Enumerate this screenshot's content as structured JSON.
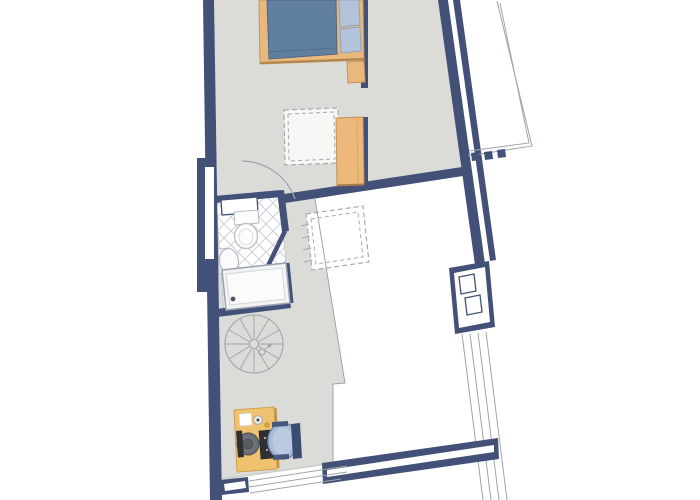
{
  "meta": {
    "title": "apartment-floor-plan",
    "canvas": {
      "width": 700,
      "height": 500,
      "background": "#ffffff"
    }
  },
  "palette": {
    "wall": "#435078",
    "floor": "#dbdbd8",
    "floor_edge": "#c6c8c4",
    "thin": "#9fa5ad",
    "dash": "#a6abb3",
    "tile_line": "#ccd0d8",
    "white": "#ffffff",
    "wood": "#e9b87d",
    "wood_dark": "#c3945a",
    "wood_shadow": "#b0854e",
    "wardrobe_shadow": "#a87c49",
    "desk": "#eec26f",
    "desk_edge": "#cfa049",
    "desk_shadow": "#c08f3e",
    "blanket": "#61809f",
    "blanket_edge": "#4c6884",
    "pillow": "#b3c4da",
    "pillow_edge": "#8fa3bd",
    "chair_seat": "#a9bdd9",
    "chair_seat_light": "#bccadf",
    "chair_rim": "#7089b0",
    "chair_back": "#3c4d72",
    "chair_arm": "#46587c",
    "dark": "#2e3034",
    "monitor": "#6b6f74",
    "fixture_line": "#b5bac2",
    "accent_yellow": "#d8a93c"
  },
  "elements": [
    {
      "name": "floor-area",
      "kind": "polygon",
      "pts": "214,0 445,0 463,171 315,199 345,383 333,384 333,464 222,480",
      "fill": "$floor"
    },
    {
      "name": "roof-window-dashed-outer",
      "kind": "polygon",
      "pts": "306,214 363,206 369,262 312,270",
      "fill": "#ffffff",
      "stroke": "$dash",
      "sw": 1.2,
      "dash": "5 3"
    },
    {
      "name": "roof-window-dashed-inner",
      "kind": "polygon",
      "pts": "311,219 358,212 363,257 316,264",
      "fill": "none",
      "stroke": "$dash",
      "sw": 1,
      "dash": "4 3"
    },
    {
      "name": "roof-hatch-line",
      "kind": "line",
      "x1": 301,
      "y1": 226,
      "x2": 309,
      "y2": 224,
      "stroke": "$dash",
      "sw": 1
    },
    {
      "name": "roof-hatch-line",
      "kind": "line",
      "x1": 302,
      "y1": 238,
      "x2": 310,
      "y2": 236,
      "stroke": "$dash",
      "sw": 1
    },
    {
      "name": "roof-hatch-line",
      "kind": "line",
      "x1": 303,
      "y1": 250,
      "x2": 311,
      "y2": 248,
      "stroke": "$dash",
      "sw": 1
    },
    {
      "name": "roof-hatch-line",
      "kind": "line",
      "x1": 304,
      "y1": 262,
      "x2": 312,
      "y2": 260,
      "stroke": "$dash",
      "sw": 1
    },
    {
      "name": "area-boundary-line",
      "kind": "polyline",
      "pts": "315,199 345,383 333,384 333,464",
      "fill": "none",
      "stroke": "$thin",
      "sw": 1
    },
    {
      "name": "floor-edge-line",
      "kind": "line",
      "x1": 222,
      "y1": 479,
      "x2": 334,
      "y2": 463,
      "stroke": "$floor_edge",
      "sw": 1
    },
    {
      "name": "skylight-dashed-outer",
      "kind": "polygon",
      "pts": "284,110 338,108 339,163 285,165",
      "fill": "#f7f7f5",
      "stroke": "$dash",
      "sw": 1.2,
      "dash": "5 3"
    },
    {
      "name": "skylight-dashed-inner",
      "kind": "polygon",
      "pts": "288,114 334,112 335,159 289,161",
      "fill": "none",
      "stroke": "$dash",
      "sw": 1,
      "dash": "4 3"
    },
    {
      "name": "spiral-stair-outer-circle",
      "kind": "circle",
      "cx": 254,
      "cy": 344,
      "r": 29,
      "fill": "none",
      "stroke": "$thin",
      "sw": 1.1
    },
    {
      "name": "spiral-stair-hub",
      "kind": "circle",
      "cx": 254,
      "cy": 344,
      "r": 4.5,
      "fill": "none",
      "stroke": "$thin",
      "sw": 1
    },
    {
      "name": "stair-spoke",
      "kind": "line",
      "x1": 259,
      "y1": 344,
      "x2": 283,
      "y2": 344,
      "stroke": "$thin",
      "sw": 0.9
    },
    {
      "name": "stair-spoke",
      "kind": "line",
      "x1": 258,
      "y1": 346,
      "x2": 279,
      "y2": 359,
      "stroke": "$thin",
      "sw": 0.9
    },
    {
      "name": "stair-spoke",
      "kind": "line",
      "x1": 256,
      "y1": 348,
      "x2": 269,
      "y2": 369,
      "stroke": "$thin",
      "sw": 0.9
    },
    {
      "name": "stair-spoke",
      "kind": "line",
      "x1": 254,
      "y1": 349,
      "x2": 254,
      "y2": 373,
      "stroke": "$thin",
      "sw": 0.9
    },
    {
      "name": "stair-spoke",
      "kind": "line",
      "x1": 252,
      "y1": 348,
      "x2": 240,
      "y2": 369,
      "stroke": "$thin",
      "sw": 0.9
    },
    {
      "name": "stair-spoke",
      "kind": "line",
      "x1": 250,
      "y1": 346,
      "x2": 229,
      "y2": 359,
      "stroke": "$thin",
      "sw": 0.9
    },
    {
      "name": "stair-spoke",
      "kind": "line",
      "x1": 250,
      "y1": 344,
      "x2": 225,
      "y2": 344,
      "stroke": "$thin",
      "sw": 0.9
    },
    {
      "name": "stair-spoke",
      "kind": "line",
      "x1": 250,
      "y1": 342,
      "x2": 229,
      "y2": 330,
      "stroke": "$thin",
      "sw": 0.9
    },
    {
      "name": "stair-spoke",
      "kind": "line",
      "x1": 252,
      "y1": 340,
      "x2": 240,
      "y2": 319,
      "stroke": "$thin",
      "sw": 0.9
    },
    {
      "name": "stair-spoke",
      "kind": "line",
      "x1": 254,
      "y1": 340,
      "x2": 254,
      "y2": 315,
      "stroke": "$thin",
      "sw": 0.9
    },
    {
      "name": "stair-spoke",
      "kind": "line",
      "x1": 256,
      "y1": 340,
      "x2": 269,
      "y2": 319,
      "stroke": "$thin",
      "sw": 0.9
    },
    {
      "name": "stair-spoke",
      "kind": "line",
      "x1": 258,
      "y1": 342,
      "x2": 279,
      "y2": 330,
      "stroke": "$thin",
      "sw": 0.9
    },
    {
      "name": "stair-direction-circle",
      "kind": "circle",
      "cx": 262,
      "cy": 352,
      "r": 3,
      "fill": "none",
      "stroke": "$thin",
      "sw": 1
    },
    {
      "name": "stair-direction-arrow",
      "kind": "line",
      "x1": 264,
      "y1": 350,
      "x2": 271,
      "y2": 345,
      "stroke": "$thin",
      "sw": 1
    },
    {
      "name": "stair-arrowhead",
      "kind": "polygon",
      "pts": "272,344 267,345 270,348",
      "fill": "$thin"
    },
    {
      "name": "bathroom-tile-floor",
      "kind": "polygon",
      "pts": "216,201 280,195 289,300 224,311",
      "fill": "url(#tilepat)",
      "stroke": "#b9bec6",
      "sw": 0.6
    },
    {
      "name": "bathroom-top-wall",
      "kind": "polygon",
      "pts": "214,196 281,190 282,197 215,203",
      "fill": "$wall"
    },
    {
      "name": "bathroom-right-wall",
      "kind": "polygon",
      "pts": "277,191 284,190 289,231 282,232",
      "fill": "$wall"
    },
    {
      "name": "bathroom-partition-wall",
      "kind": "line",
      "x1": 285,
      "y1": 231,
      "x2": 263,
      "y2": 276,
      "stroke": "$wall",
      "sw": 4.5
    },
    {
      "name": "shower-side-wall",
      "kind": "line",
      "x1": 287,
      "y1": 263,
      "x2": 291,
      "y2": 303,
      "stroke": "$wall",
      "sw": 5
    },
    {
      "name": "bathroom-bottom-wall",
      "kind": "polygon",
      "pts": "216,309 290,300 291,308 217,317",
      "fill": "$wall"
    },
    {
      "name": "bathroom-door-panel",
      "kind": "polygon",
      "pts": "221,200 257,197 258,212 222,215",
      "fill": "#ffffff",
      "stroke": "$wall",
      "sw": 1.3
    },
    {
      "name": "toilet-tank",
      "kind": "polygon",
      "pts": "234,212 258,210 259,223 235,225",
      "fill": "#fcfcfc",
      "stroke": "$fixture_line",
      "sw": 1
    },
    {
      "name": "toilet-bowl",
      "kind": "ellipse",
      "cx": 246,
      "cy": 236,
      "rx": 11.5,
      "ry": 12.5,
      "fill": "#fdfdfd",
      "stroke": "$fixture_line",
      "sw": 1.2
    },
    {
      "name": "toilet-bowl-inner",
      "kind": "ellipse",
      "cx": 246,
      "cy": 237,
      "rx": 7,
      "ry": 8,
      "fill": "none",
      "stroke": "#d8dbdf",
      "sw": 1
    },
    {
      "name": "sink-pedestal",
      "kind": "polygon",
      "pts": "218,249 227,248 228,273 219,274",
      "fill": "#edeef1",
      "stroke": "$fixture_line",
      "sw": 0.8
    },
    {
      "name": "sink-basin",
      "kind": "ellipse",
      "cx": 229,
      "cy": 261,
      "rx": 9.5,
      "ry": 12.5,
      "fill": "#fbfbfc",
      "stroke": "$fixture_line",
      "sw": 1.2,
      "rot": [
        -8,
        229,
        261
      ]
    },
    {
      "name": "shower-tray",
      "kind": "polygon",
      "pts": "222,270 286,263 290,303 226,310",
      "fill": "#f2f3f2",
      "stroke": "#99a2b2",
      "sw": 1.5
    },
    {
      "name": "shower-tray-inner",
      "kind": "polygon",
      "pts": "226,274 282,268 285,299 230,305",
      "fill": "#fbfbfb",
      "stroke": "#d3d6da",
      "sw": 1
    },
    {
      "name": "shower-drain",
      "kind": "circle",
      "cx": 233,
      "cy": 299,
      "r": 2.4,
      "fill": "#51555c"
    },
    {
      "name": "left-wall",
      "kind": "polygon",
      "pts": "203,0 214,0 222,500 210,500",
      "fill": "$wall"
    },
    {
      "name": "left-wall-alcove",
      "kind": "polygon",
      "pts": "197,158 216,158 216,292 197,292",
      "fill": "$wall"
    },
    {
      "name": "left-window",
      "kind": "polygon",
      "pts": "205,167 214,167 214,259 205,259",
      "fill": "#ffffff"
    },
    {
      "name": "closet-wall-upper",
      "kind": "polygon",
      "pts": "361,0 368,0 368,88 361,88",
      "fill": "$wall"
    },
    {
      "name": "closet-wall-lower",
      "kind": "polygon",
      "pts": "361,117 368,117 368,185 361,185",
      "fill": "$wall"
    },
    {
      "name": "interior-wall",
      "kind": "polygon",
      "pts": "284,194 462,167 463,176 285,203",
      "fill": "$wall"
    },
    {
      "name": "right-wall-outer-leaf",
      "kind": "polygon",
      "pts": "438,0 448,0 485,263 475,265",
      "fill": "$wall"
    },
    {
      "name": "right-wall-window-stripe",
      "kind": "polygon",
      "pts": "448,0 453,0 490,261 485,263",
      "fill": "#ffffff"
    },
    {
      "name": "right-wall-inner-leaf",
      "kind": "polygon",
      "pts": "453,0 460,0 496,260 490,261",
      "fill": "$wall"
    },
    {
      "name": "chimney-outer",
      "kind": "polygon",
      "pts": "449,268 489,261 495,327 455,334",
      "fill": "$wall"
    },
    {
      "name": "chimney-inner",
      "kind": "polygon",
      "pts": "454,273 485,267 490,322 459,328",
      "fill": "#ffffff"
    },
    {
      "name": "chimney-flue-1",
      "kind": "polygon",
      "pts": "459,277 474,274 476,291 461,294",
      "fill": "#ffffff",
      "stroke": "$wall",
      "sw": 1.3
    },
    {
      "name": "chimney-flue-2",
      "kind": "polygon",
      "pts": "465,298 480,295 482,312 467,315",
      "fill": "#ffffff",
      "stroke": "$wall",
      "sw": 1.3
    },
    {
      "name": "terrace-outline-outer",
      "kind": "polyline",
      "pts": "497,1 532,146 468,156",
      "fill": "none",
      "stroke": "$thin",
      "sw": 1
    },
    {
      "name": "terrace-outline-inner",
      "kind": "polyline",
      "pts": "500,3 529,143 469,151",
      "fill": "none",
      "stroke": "$thin",
      "sw": 1
    },
    {
      "name": "terrace-post",
      "kind": "polygon",
      "pts": "471,153 479,152 480,160 472,161",
      "fill": "$wall"
    },
    {
      "name": "terrace-post",
      "kind": "polygon",
      "pts": "484,152 492,151 493,159 485,160",
      "fill": "$wall"
    },
    {
      "name": "terrace-post",
      "kind": "polygon",
      "pts": "497,150 505,149 506,157 498,158",
      "fill": "$wall"
    },
    {
      "name": "railing-line",
      "kind": "line",
      "x1": 462,
      "y1": 334,
      "x2": 483,
      "y2": 500,
      "stroke": "$thin",
      "sw": 1
    },
    {
      "name": "railing-line",
      "kind": "line",
      "x1": 470,
      "y1": 334,
      "x2": 491,
      "y2": 500,
      "stroke": "$thin",
      "sw": 1
    },
    {
      "name": "railing-line",
      "kind": "line",
      "x1": 478,
      "y1": 333,
      "x2": 499,
      "y2": 500,
      "stroke": "$thin",
      "sw": 1
    },
    {
      "name": "railing-line",
      "kind": "line",
      "x1": 486,
      "y1": 332,
      "x2": 507,
      "y2": 500,
      "stroke": "$thin",
      "sw": 1
    },
    {
      "name": "south-window-band",
      "kind": "polygon",
      "pts": "322,463 498,438 499,459 323,484",
      "fill": "$wall"
    },
    {
      "name": "south-window-stripe",
      "kind": "polygon",
      "pts": "327,470 494,445 494,452 327,477",
      "fill": "#ffffff"
    },
    {
      "name": "southwest-sill",
      "kind": "polygon",
      "pts": "220,480 248,477 249,492 221,495",
      "fill": "$wall"
    },
    {
      "name": "southwest-sill-stripe",
      "kind": "polygon",
      "pts": "224,484 245,481 246,488 225,491",
      "fill": "#ffffff"
    },
    {
      "name": "southwest-window-line",
      "kind": "line",
      "x1": 249,
      "y1": 481,
      "x2": 347,
      "y2": 466,
      "stroke": "$thin",
      "sw": 1
    },
    {
      "name": "southwest-window-line",
      "kind": "line",
      "x1": 249,
      "y1": 487,
      "x2": 347,
      "y2": 472,
      "stroke": "$thin",
      "sw": 1
    },
    {
      "name": "southwest-window-line",
      "kind": "line",
      "x1": 250,
      "y1": 493,
      "x2": 341,
      "y2": 479,
      "stroke": "$thin",
      "sw": 1
    },
    {
      "name": "door-swing-arc",
      "kind": "path",
      "d": "M242,161 A57 57 0 0 1 295,199",
      "fill": "none",
      "stroke": "$thin",
      "sw": 1.2
    },
    {
      "name": "bed-frame",
      "kind": "polygon",
      "pts": "259,0 363,0 364,60 260,64",
      "fill": "$wood",
      "stroke": "$wood_dark",
      "sw": 1
    },
    {
      "name": "bed-frame-shadow",
      "kind": "line",
      "x1": 260,
      "y1": 63,
      "x2": 364,
      "y2": 59,
      "stroke": "$wood_shadow",
      "sw": 2
    },
    {
      "name": "bed-blanket",
      "kind": "polygon",
      "pts": "267,0 336,0 337,54 269,59",
      "fill": "$blanket",
      "stroke": "$blanket_edge",
      "sw": 1
    },
    {
      "name": "bed-blanket-fold",
      "kind": "line",
      "x1": 268,
      "y1": 52,
      "x2": 336,
      "y2": 48,
      "stroke": "#51708f",
      "sw": 1
    },
    {
      "name": "bed-pillow",
      "kind": "polygon",
      "pts": "339,0 359,0 360,25 340,27",
      "fill": "$pillow",
      "stroke": "$pillow_edge",
      "sw": 1
    },
    {
      "name": "bed-pillow",
      "kind": "polygon",
      "pts": "340,29 360,27 361,51 341,53",
      "fill": "$pillow",
      "stroke": "$pillow_edge",
      "sw": 1
    },
    {
      "name": "nightstand",
      "kind": "polygon",
      "pts": "347,62 364,61 365,82 348,83",
      "fill": "$wood",
      "stroke": "$wood_dark",
      "sw": 1
    },
    {
      "name": "wardrobe",
      "kind": "polygon",
      "pts": "336,118 363,117 364,184 337,185",
      "fill": "#edb97b",
      "stroke": "$wood_dark",
      "sw": 1
    },
    {
      "name": "wardrobe-panel-line",
      "kind": "line",
      "x1": 357,
      "y1": 118,
      "x2": 358,
      "y2": 183,
      "stroke": "#d9a55e",
      "sw": 1
    },
    {
      "name": "wardrobe-shadow",
      "kind": "line",
      "x1": 337,
      "y1": 185.5,
      "x2": 364,
      "y2": 184.5,
      "stroke": "$wardrobe_shadow",
      "sw": 2
    },
    {
      "name": "desk",
      "kind": "polygon",
      "pts": "234,410 274,407 277,469 237,472",
      "fill": "$desk",
      "stroke": "$desk_edge",
      "sw": 1
    },
    {
      "name": "desk-shadow-edge",
      "kind": "line",
      "x1": 275.5,
      "y1": 408,
      "x2": 278.5,
      "y2": 468,
      "stroke": "$desk_shadow",
      "sw": 2
    },
    {
      "name": "desk-paper",
      "kind": "polygon",
      "pts": "239,414 251,413 252,425 240,426",
      "fill": "#ffffff",
      "stroke": "#d8d8d6",
      "sw": 0.7
    },
    {
      "name": "desk-gadget",
      "kind": "circle",
      "cx": 258,
      "cy": 420,
      "r": 4.3,
      "fill": "#f3f3f3",
      "stroke": "$thin",
      "sw": 1
    },
    {
      "name": "desk-gadget-dot",
      "kind": "circle",
      "cx": 258,
      "cy": 420,
      "r": 1.6,
      "fill": "#555555"
    },
    {
      "name": "desk-accessory",
      "kind": "circle",
      "cx": 267,
      "cy": 425,
      "r": 2.2,
      "fill": "$accent_yellow",
      "stroke": "#a97f23",
      "sw": 0.7
    },
    {
      "name": "monitor-body",
      "kind": "circle",
      "cx": 248,
      "cy": 444,
      "r": 11,
      "fill": "$monitor",
      "stroke": "#4a4d52",
      "sw": 1
    },
    {
      "name": "monitor-ring",
      "kind": "circle",
      "cx": 248,
      "cy": 444,
      "r": 6.5,
      "fill": "#585c62",
      "stroke": "#7d8187",
      "sw": 1
    },
    {
      "name": "monitor-screen",
      "kind": "polygon",
      "pts": "236,431 242,430.5 244,457 238,457.5",
      "fill": "$dark"
    },
    {
      "name": "keyboard",
      "kind": "polygon",
      "pts": "259,431 271,430 273,458 261,459",
      "fill": "$dark",
      "stroke": "#17191c",
      "sw": 0.6
    },
    {
      "name": "keyboard-key-dot",
      "kind": "circle",
      "cx": 265,
      "cy": 438,
      "r": 1,
      "fill": "#cfd2d6"
    },
    {
      "name": "keyboard-key-dot",
      "kind": "circle",
      "cx": 267,
      "cy": 450,
      "r": 1,
      "fill": "#cfd2d6"
    },
    {
      "name": "office-chair-seat",
      "kind": "ellipse",
      "cx": 283,
      "cy": 441,
      "rx": 15,
      "ry": 18,
      "fill": "$chair_seat",
      "stroke": "$chair_rim",
      "sw": 1.5
    },
    {
      "name": "office-chair-cushion",
      "kind": "ellipse",
      "cx": 283,
      "cy": 441,
      "rx": 10.5,
      "ry": 13.5,
      "fill": "$chair_seat_light"
    },
    {
      "name": "office-chair-back",
      "kind": "polygon",
      "pts": "291,424 300,423 302,458 293,459",
      "fill": "$chair_back"
    },
    {
      "name": "office-chair-armrest",
      "kind": "polygon",
      "pts": "272,422 288,421 288,426 272,427",
      "fill": "$chair_arm"
    },
    {
      "name": "office-chair-armrest",
      "kind": "polygon",
      "pts": "273,455 289,454 289,459 273,460",
      "fill": "$chair_arm"
    }
  ]
}
